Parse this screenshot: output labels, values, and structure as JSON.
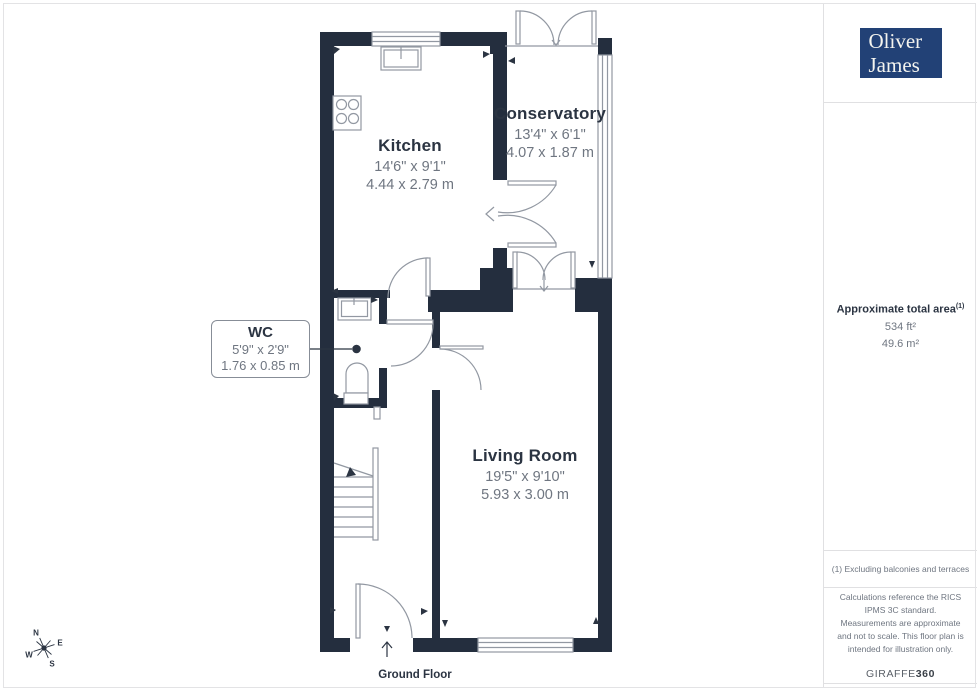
{
  "branding": {
    "logo_line1": "Oliver",
    "logo_line2": "James",
    "logo_bg_color": "#224176"
  },
  "sidebar": {
    "area": {
      "heading": "Approximate total area",
      "footnote_ref": "(1)",
      "imperial": "534 ft²",
      "metric": "49.6 m²"
    },
    "footnote": "(1) Excluding balconies and terraces",
    "disclaimer": "Calculations reference the RICS IPMS 3C standard. Measurements are approximate and not to scale. This floor plan is intended for illustration only.",
    "provider_name": "GIRAFFE",
    "provider_suffix": "360"
  },
  "floorplan": {
    "floor_label": "Ground Floor",
    "rooms": [
      {
        "name": "Kitchen",
        "imperial": "14'6\" x 9'1\"",
        "metric": "4.44 x 2.79 m"
      },
      {
        "name": "Conservatory",
        "imperial": "13'4\" x 6'1\"",
        "metric": "4.07 x 1.87 m"
      },
      {
        "name": "WC",
        "imperial": "5'9\" x 2'9\"",
        "metric": "1.76 x 0.85 m"
      },
      {
        "name": "Living Room",
        "imperial": "19'5\" x 9'10\"",
        "metric": "5.93 x 3.00 m"
      }
    ],
    "compass": {
      "n": "N",
      "e": "E",
      "s": "S",
      "w": "W"
    },
    "colors": {
      "wall": "#242e3e",
      "fixture_line": "#9298a2",
      "text_dark": "#2b3442",
      "text_gray": "#6f7681"
    }
  }
}
